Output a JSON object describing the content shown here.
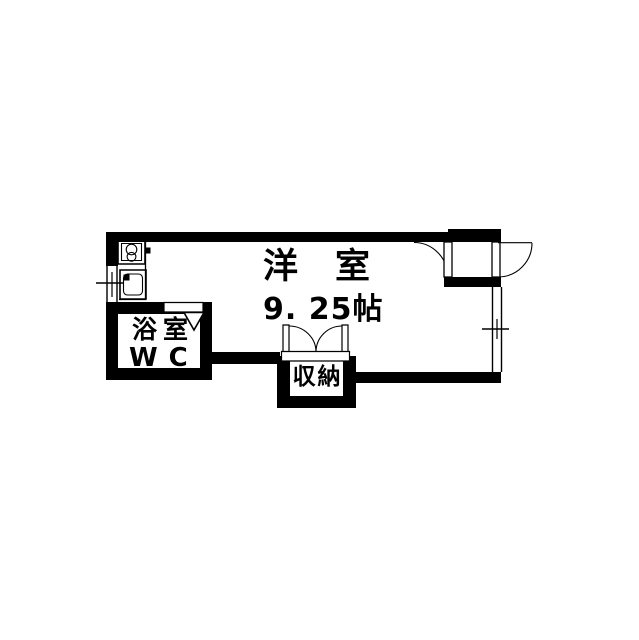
{
  "page": {
    "background": "#ffffff",
    "ink": "#000000"
  },
  "floorplan": {
    "kind": "apartment-room-floorplan",
    "rooms": {
      "main": {
        "name": "洋　室",
        "size": "9. 25帖"
      },
      "bath": {
        "line1": "浴室",
        "line2": "WC"
      },
      "closet": {
        "name": "収納"
      }
    },
    "fixtures": [
      {
        "icon": "stove-icon"
      },
      {
        "icon": "sink-icon"
      },
      {
        "icon": "left-window-icon"
      },
      {
        "icon": "right-window-icon"
      },
      {
        "icon": "bath-door-icon"
      },
      {
        "icon": "entrance-door-swing-icon"
      },
      {
        "icon": "interior-door-swing-icon"
      },
      {
        "icon": "closet-double-door-swing-icon"
      }
    ]
  }
}
